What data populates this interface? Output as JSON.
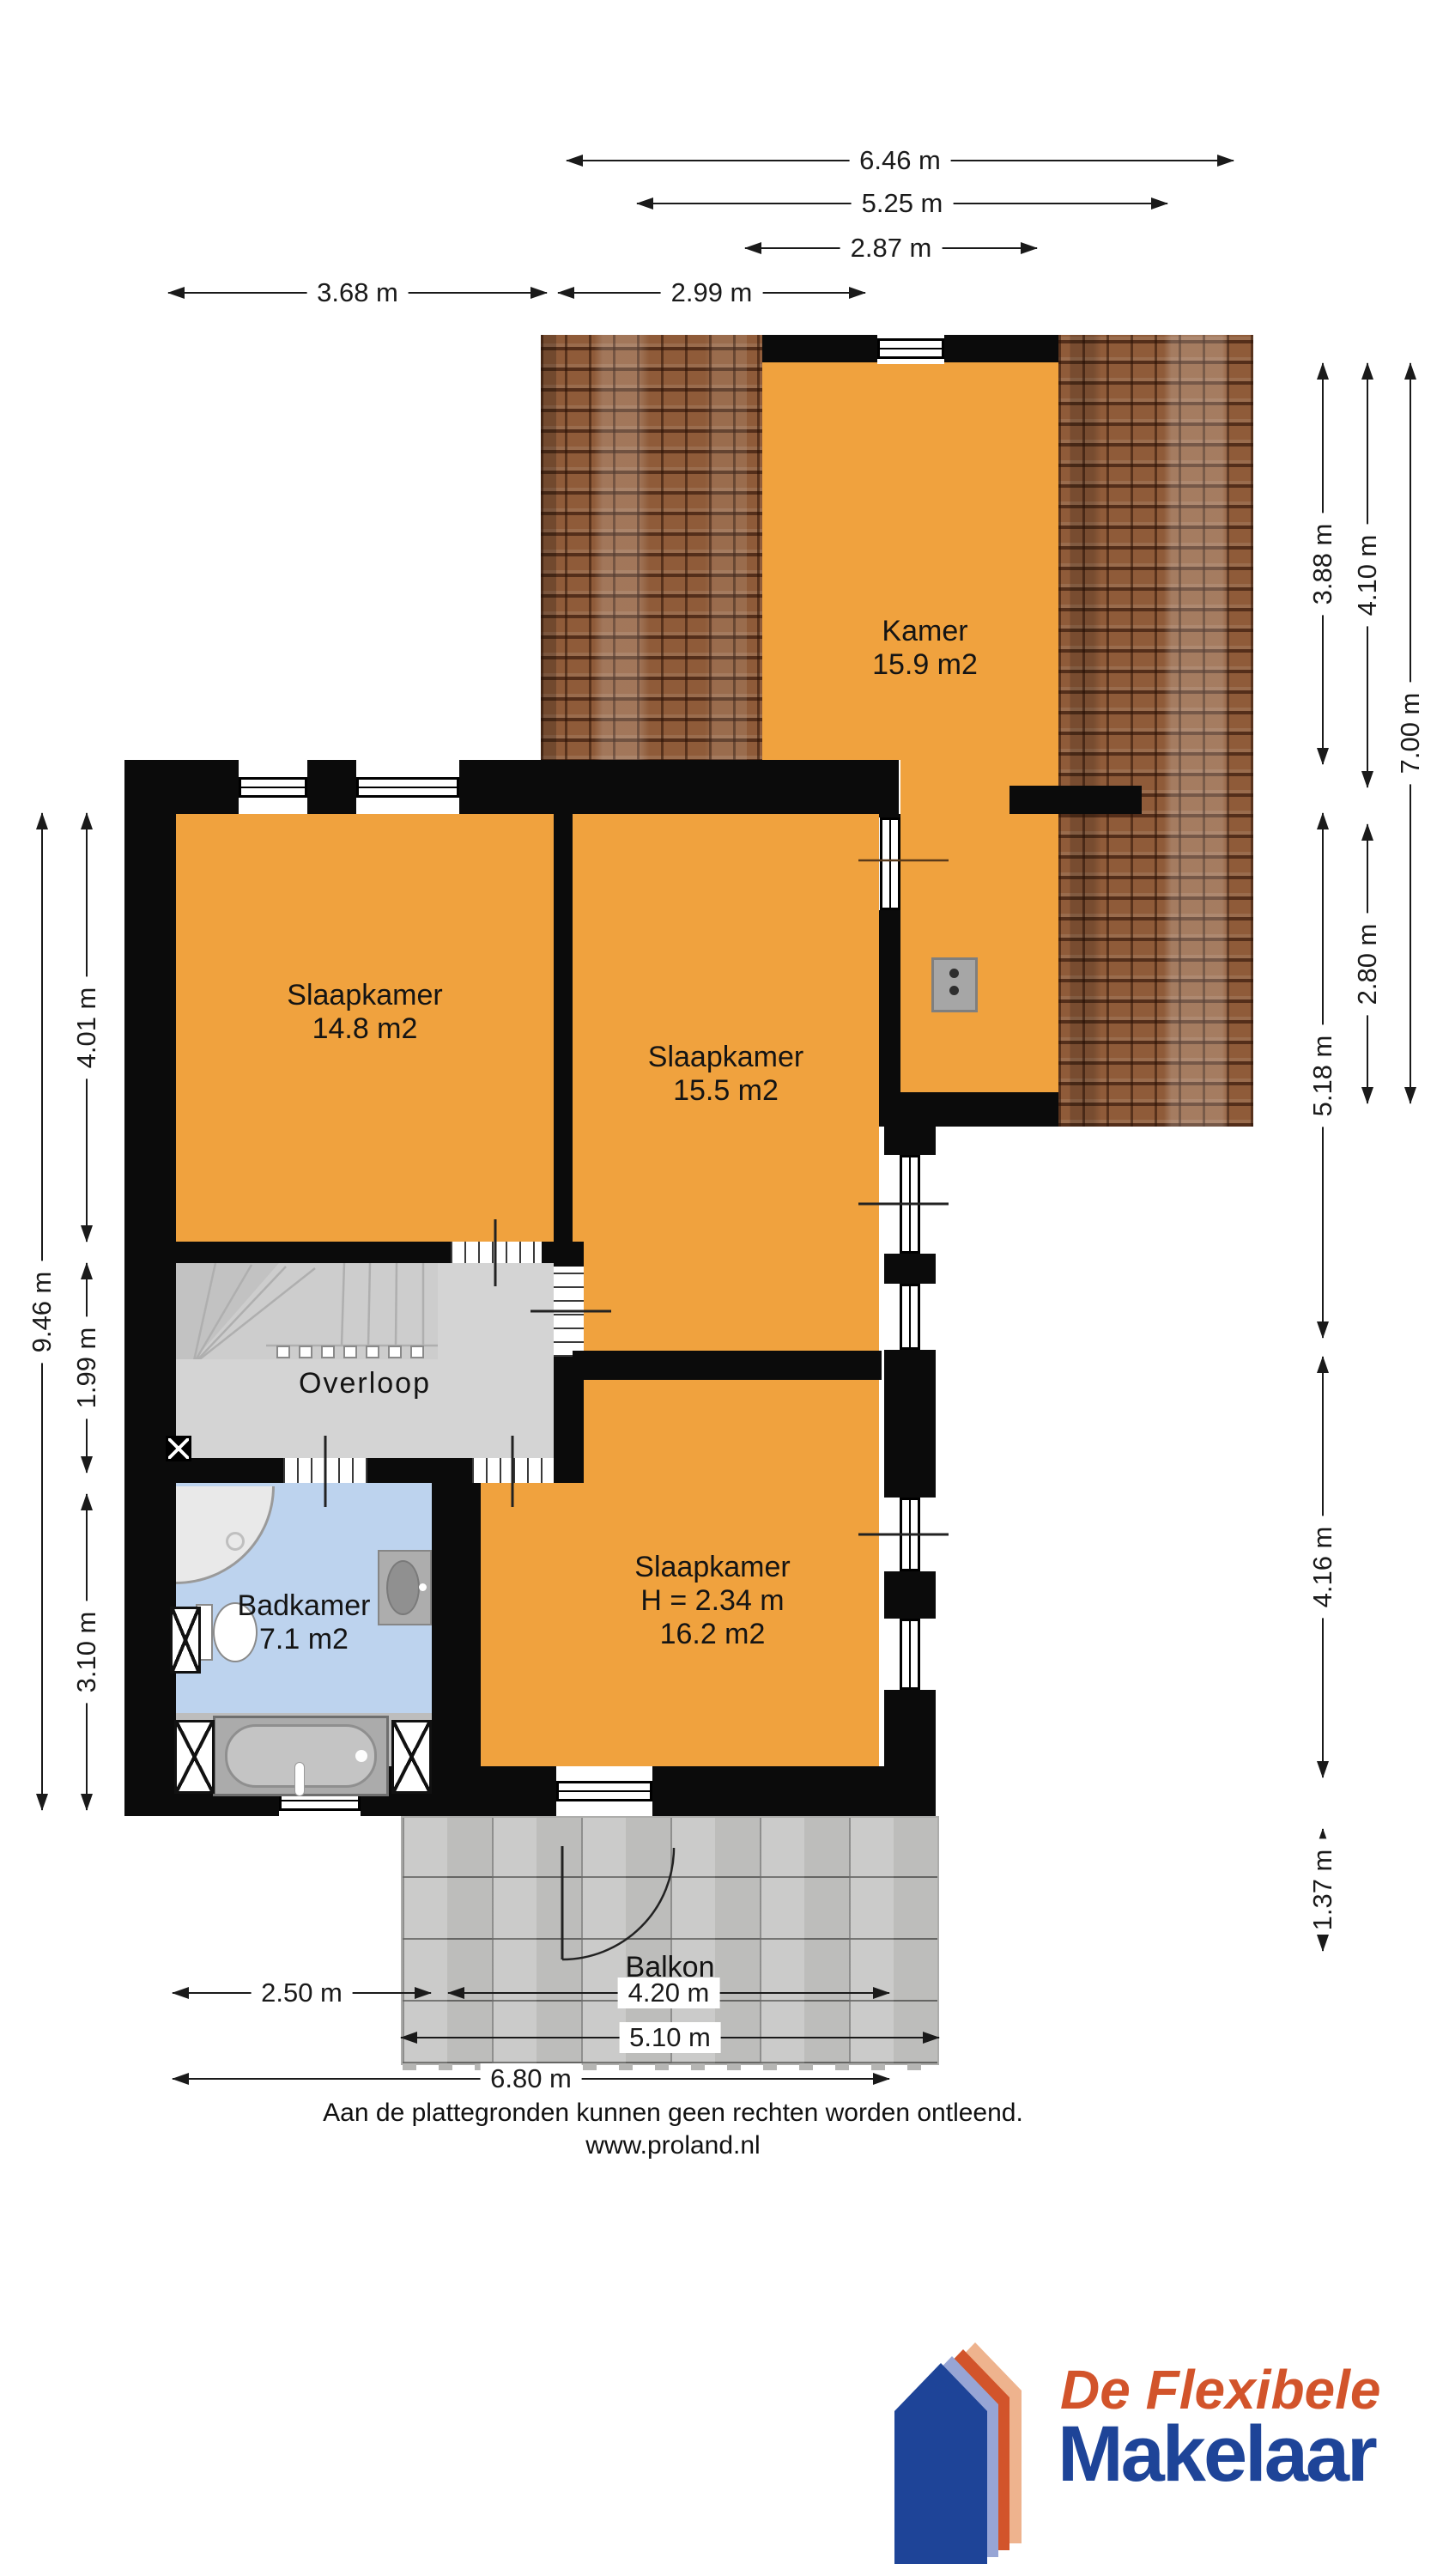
{
  "rooms": {
    "kamer": {
      "name": "Kamer",
      "area": "15.9 m2"
    },
    "slaapkamer_left": {
      "name": "Slaapkamer",
      "area": "14.8 m2"
    },
    "slaapkamer_mid": {
      "name": "Slaapkamer",
      "area": "15.5 m2"
    },
    "overloop": {
      "name": "Overloop"
    },
    "badkamer": {
      "name": "Badkamer",
      "area": "7.1 m2"
    },
    "slaapkamer_bottom": {
      "name": "Slaapkamer",
      "height": "H = 2.34 m",
      "area": "16.2 m2"
    },
    "balkon": {
      "name": "Balkon"
    }
  },
  "dims": {
    "top": [
      "6.46 m",
      "5.25 m",
      "2.87 m",
      "3.68 m",
      "2.99 m"
    ],
    "bottom": [
      "2.50 m",
      "4.20 m",
      "5.10 m",
      "6.80 m"
    ],
    "left": [
      "9.46 m",
      "4.01 m",
      "1.99 m",
      "3.10 m"
    ],
    "right": [
      "3.88 m",
      "5.18 m",
      "4.16 m",
      "1.37 m",
      "4.10 m",
      "2.80 m",
      "7.00 m"
    ]
  },
  "footer": {
    "disclaimer": "Aan de plattegronden kunnen geen rechten worden ontleend.",
    "website": "www.proland.nl"
  },
  "logo": {
    "tagline": "De Flexibele",
    "brand": "Makelaar"
  },
  "colors": {
    "room_fill": "#F0A23E",
    "bathroom_fill": "#BDD3EE",
    "landing_fill": "#D4D4D4",
    "wall": "#0B0B0B",
    "roof_tile": "#8F5B39",
    "balcony_tile": "#C7C7C5",
    "logo_orange": "#D2542B",
    "logo_blue": "#1E4498"
  }
}
